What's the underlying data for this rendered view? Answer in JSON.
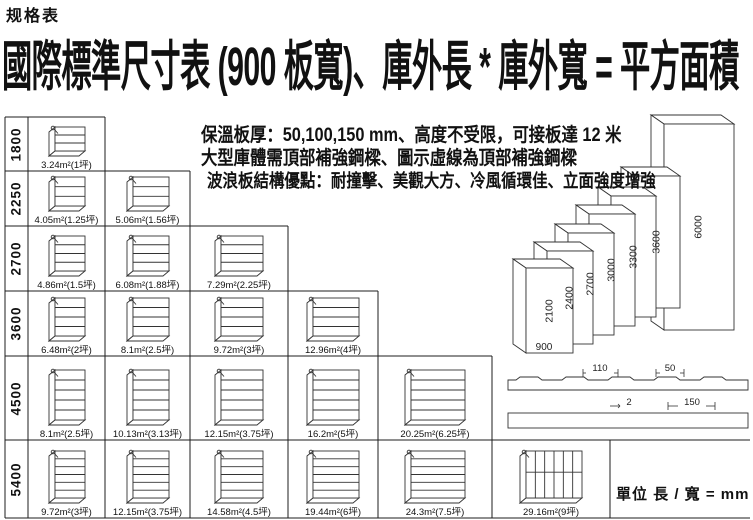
{
  "header": {
    "doc_label": "规格表",
    "title": "國際標準尺寸表 (900 板寬)、庫外長 * 庫外寬 = 平方面積"
  },
  "notes": {
    "line1": "保溫板厚：50,100,150 mm、高度不受限，可接板達 12 米",
    "line2": "大型庫體需頂部補強鋼樑、圖示虛線為頂部補強鋼樑",
    "line3": "波浪板結構優點：耐撞擊、美觀大方、冷風循環佳、立面強度增強"
  },
  "size_table": {
    "unit_note": "單位 長 / 寬 = mm",
    "rows": [
      {
        "height_mm": "1800",
        "cells": [
          "3.24m²(1坪)"
        ]
      },
      {
        "height_mm": "2250",
        "cells": [
          "4.05m²(1.25坪)",
          "5.06m²(1.56坪)"
        ]
      },
      {
        "height_mm": "2700",
        "cells": [
          "4.86m²(1.5坪)",
          "6.08m²(1.88坪)",
          "7.29m²(2.25坪)"
        ]
      },
      {
        "height_mm": "3600",
        "cells": [
          "6.48m²(2坪)",
          "8.1m²(2.5坪)",
          "9.72m²(3坪)",
          "12.96m²(4坪)"
        ]
      },
      {
        "height_mm": "4500",
        "cells": [
          "8.1m²(2.5坪)",
          "10.13m²(3.13坪)",
          "12.15m²(3.75坪)",
          "16.2m²(5坪)",
          "20.25m²(6.25坪)"
        ]
      },
      {
        "height_mm": "5400",
        "cells": [
          "9.72m²(3坪)",
          "12.15m²(3.75坪)",
          "14.58m²(4.5坪)",
          "19.44m²(6坪)",
          "24.3m²(7.5坪)",
          "29.16m²(9坪)"
        ]
      }
    ]
  },
  "panel_stack": {
    "width_label": "900",
    "height_labels": [
      "2100",
      "2400",
      "2700",
      "3000",
      "3300",
      "3600",
      "6000"
    ]
  },
  "cross_sections": {
    "wave_dims": [
      "110",
      "50"
    ],
    "flat_dims": [
      "2",
      "150"
    ]
  }
}
